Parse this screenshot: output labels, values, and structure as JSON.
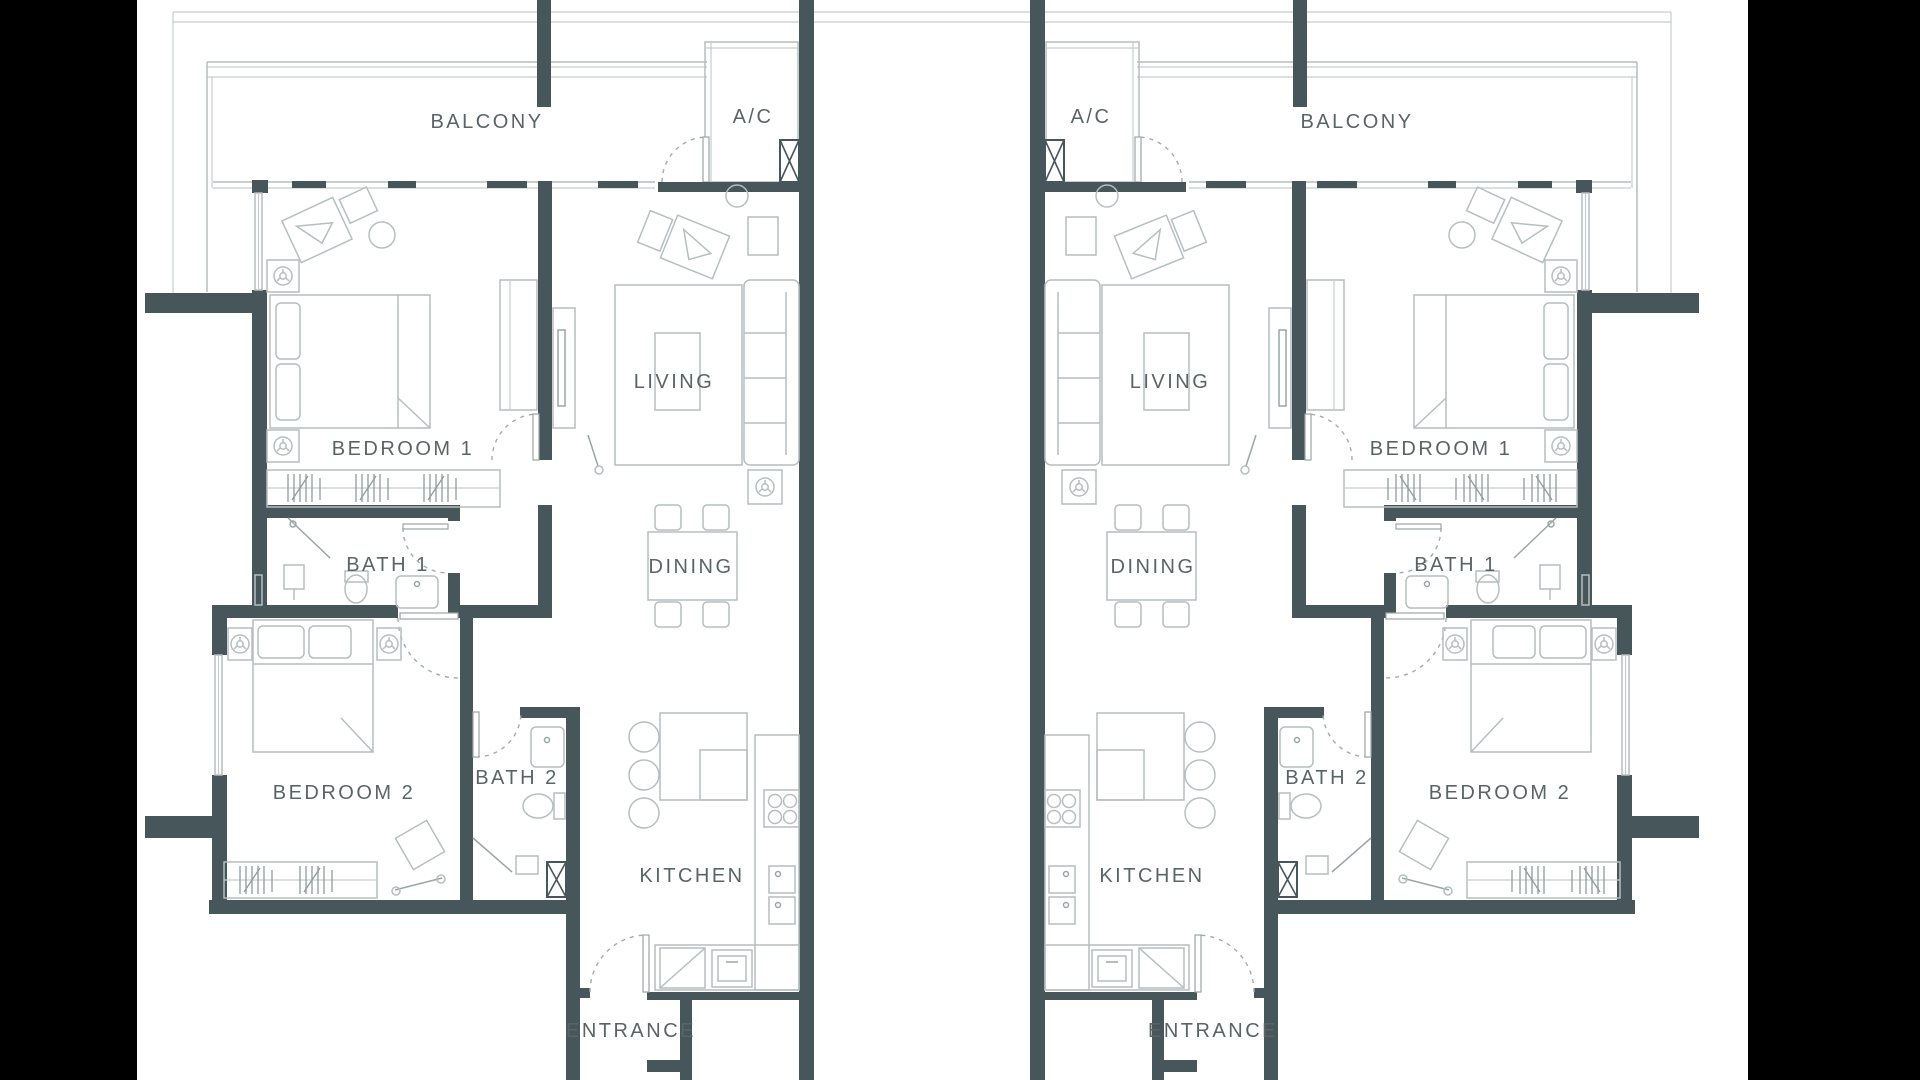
{
  "title": "Two mirrored apartment unit floor plans",
  "colors": {
    "letterbox": "#000000",
    "paper": "#ffffff",
    "wall": "#46565a",
    "furniture_line": "#b6bec0",
    "fixture_line": "#9aa5a7",
    "label_text": "#5a6466"
  },
  "units": {
    "left": {
      "labels": {
        "balcony": "BALCONY",
        "ac": "A/C",
        "living": "LIVING",
        "bedroom1": "BEDROOM 1",
        "bath1": "BATH 1",
        "dining": "DINING",
        "bedroom2": "BEDROOM 2",
        "bath2": "BATH 2",
        "kitchen": "KITCHEN",
        "entrance": "ENTRANCE"
      }
    },
    "right": {
      "labels": {
        "balcony": "BALCONY",
        "ac": "A/C",
        "living": "LIVING",
        "bedroom1": "BEDROOM 1",
        "bath1": "BATH 1",
        "dining": "DINING",
        "bedroom2": "BEDROOM 2",
        "bath2": "BATH 2",
        "kitchen": "KITCHEN",
        "entrance": "ENTRANCE"
      }
    }
  }
}
